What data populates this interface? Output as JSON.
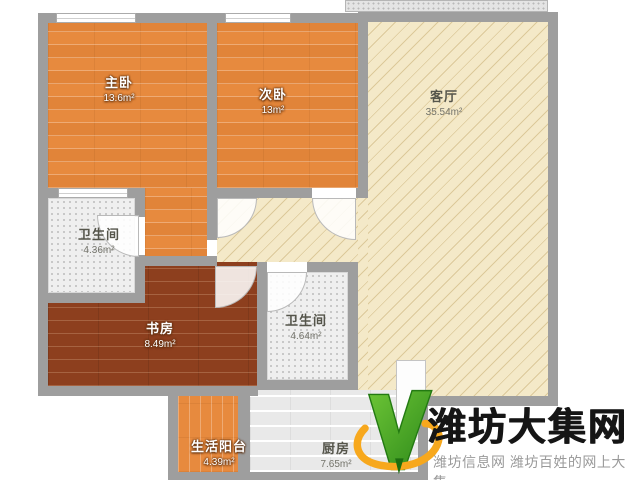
{
  "floorplan": {
    "rooms": [
      {
        "id": "master-bedroom",
        "name": "主卧",
        "area": "13.6m²"
      },
      {
        "id": "second-bedroom",
        "name": "次卧",
        "area": "13m²"
      },
      {
        "id": "living-room",
        "name": "客厅",
        "area": "35.54m²"
      },
      {
        "id": "bathroom-1",
        "name": "卫生间",
        "area": "4.36m²"
      },
      {
        "id": "study",
        "name": "书房",
        "area": "8.49m²"
      },
      {
        "id": "bathroom-2",
        "name": "卫生间",
        "area": "4.64m²"
      },
      {
        "id": "balcony",
        "name": "生活阳台",
        "area": "4.39m²"
      },
      {
        "id": "kitchen",
        "name": "厨房",
        "area": "7.65m²"
      }
    ],
    "colors": {
      "wood": "#e78a3e",
      "study": "#8d3f1e",
      "beige": "#f4e9c8",
      "hatch": "#dcc99a",
      "wall": "#9e9e9e",
      "tile": "#efefef",
      "tiledot": "#bdbdbd",
      "kitchen": "#e9e9e9",
      "logo-green": "#4fae27",
      "logo-orange": "#f7a81d"
    }
  },
  "watermark": {
    "title": "潍坊大集网",
    "subtitle": "潍坊信息网 潍坊百姓的网上大集",
    "logo_icon": "v-check-logo"
  }
}
